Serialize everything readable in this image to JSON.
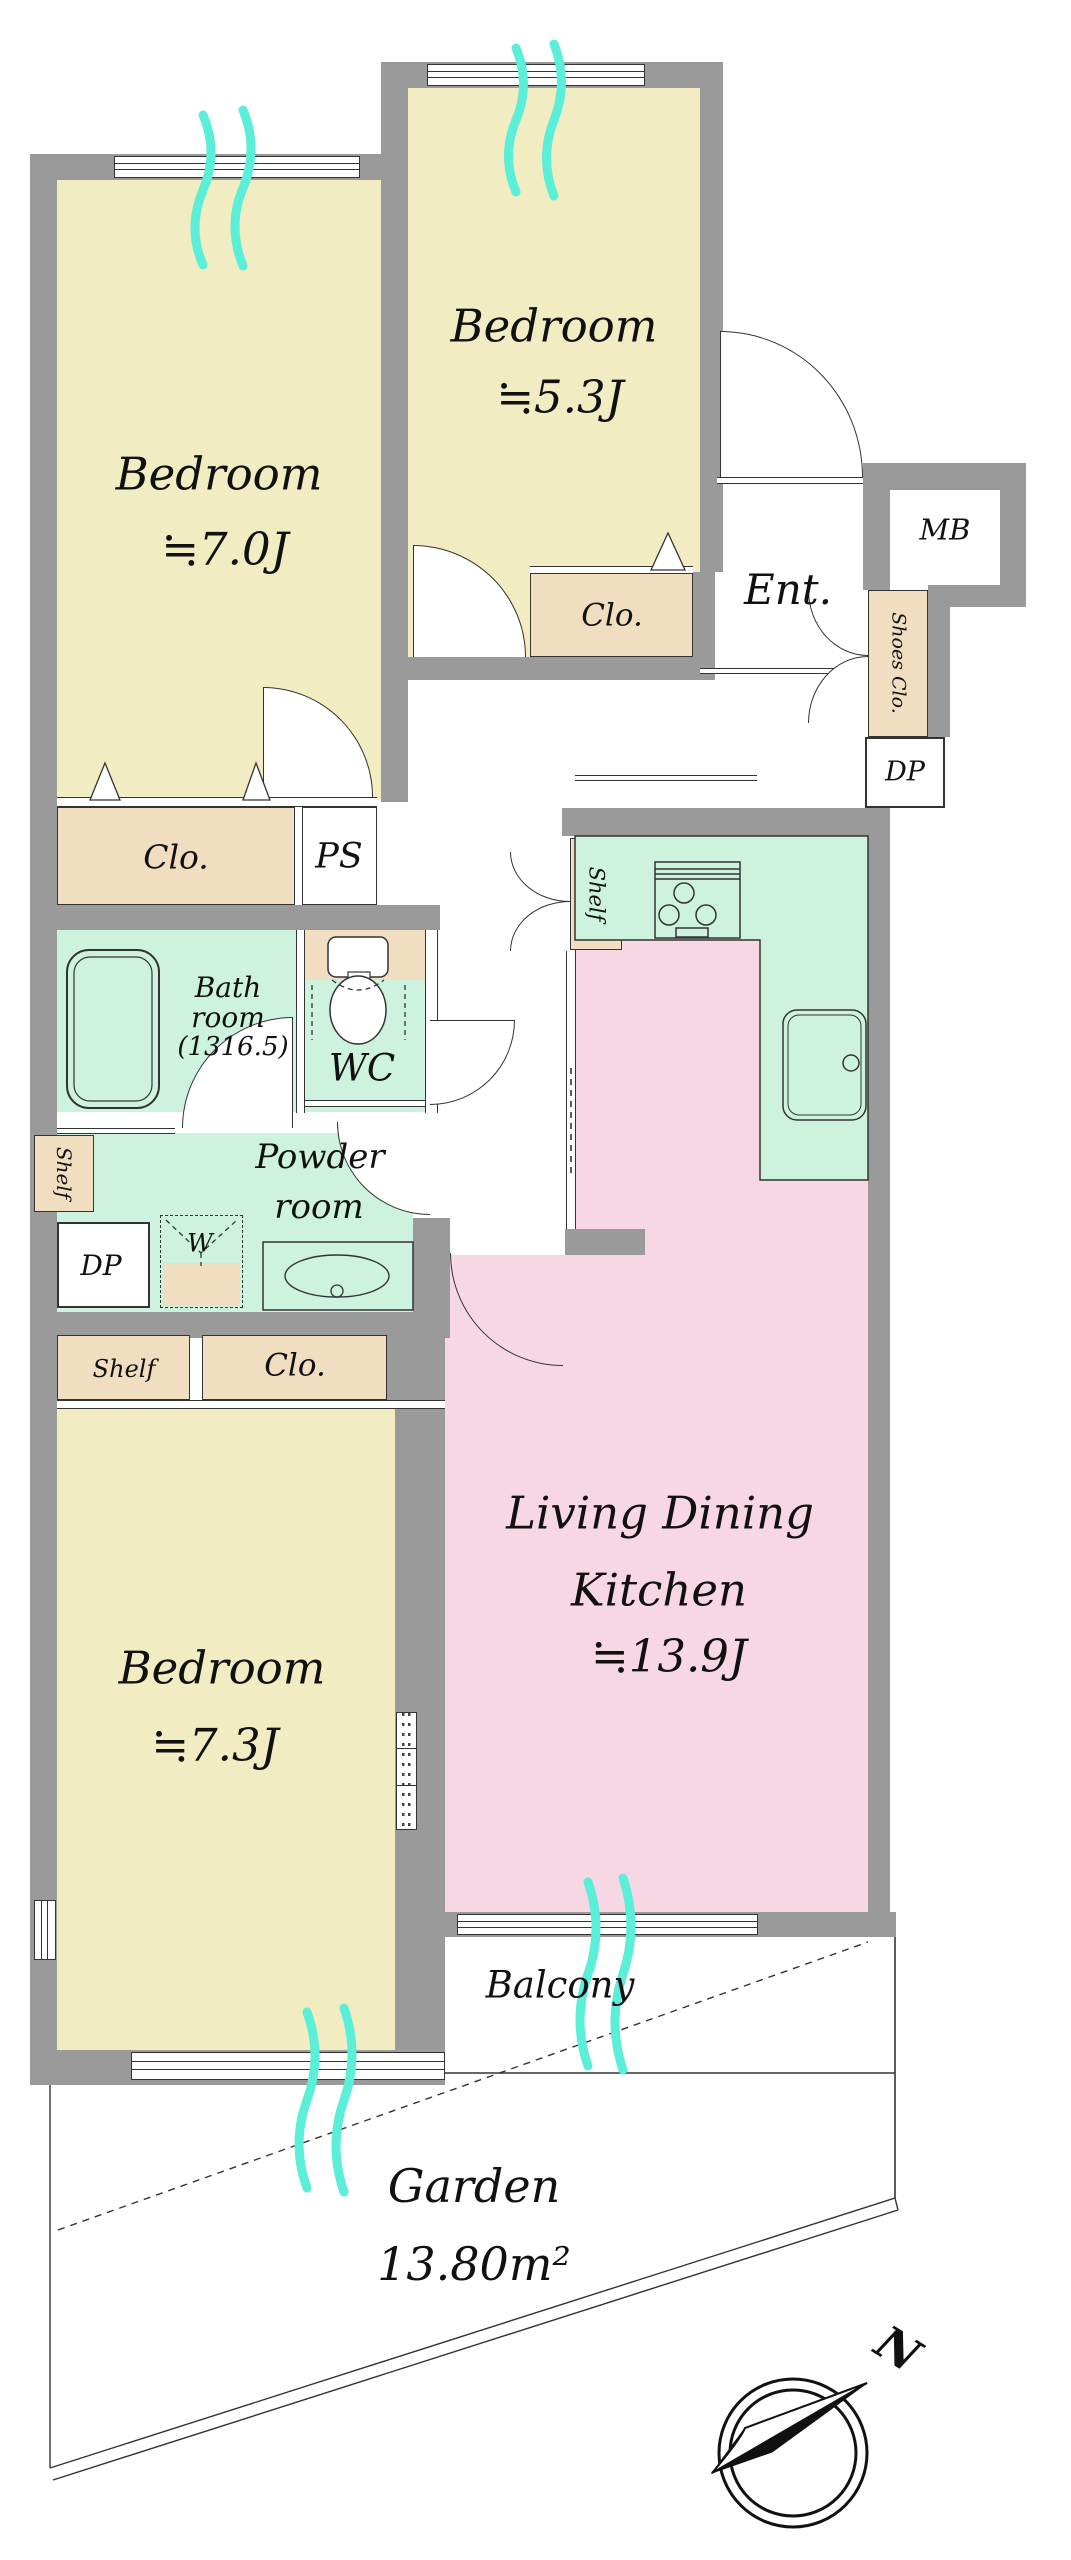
{
  "labels": {
    "bedroom_7_0": {
      "name": "Bedroom",
      "size": "≒7.0J"
    },
    "bedroom_5_3": {
      "name": "Bedroom",
      "size": "≒5.3J"
    },
    "bedroom_7_3": {
      "name": "Bedroom",
      "size": "≒7.3J"
    },
    "ldk": {
      "line1": "Living Dining",
      "line2": "Kitchen",
      "size": "≒13.9J"
    },
    "bathroom": {
      "line1": "Bath",
      "line2": "room",
      "line3": "(1316.5)"
    },
    "wc": "WC",
    "powder": {
      "line1": "Powder",
      "line2": "room"
    },
    "entrance": "Ent.",
    "meter_box": "MB",
    "shoes_closet": "Shoes Clo.",
    "closet_5_3": "Clo.",
    "closet_7_0": "Clo.",
    "closet_7_3": "Clo.",
    "pipe_space": "PS",
    "dp_entrance": "DP",
    "dp_powder": "DP",
    "shelf_powder": "Shelf",
    "shelf_kitchen": "Shelf",
    "shelf_7_3": "Shelf",
    "washer": "W",
    "balcony": "Balcony",
    "garden": {
      "name": "Garden",
      "area": "13.80m²"
    },
    "compass_north": "N"
  },
  "colors": {
    "wall": "#9a9a9a",
    "room_yellow": "#f2ecc3",
    "closet_tan": "#f1dec1",
    "wet_area_mint": "#cdf3de",
    "ldk_pink": "#f8d7e4",
    "curtain": "#5beed8",
    "line": "#222222"
  }
}
